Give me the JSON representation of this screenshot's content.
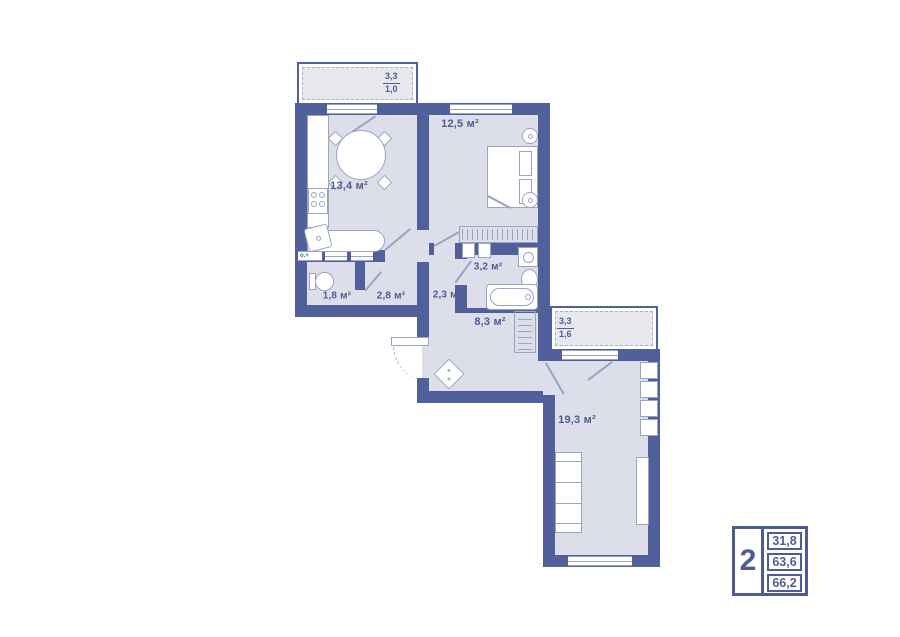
{
  "colors": {
    "wall": "#51609a",
    "floor": "#dcdee9",
    "line": "#9aa3c4",
    "text": "#4d5c94",
    "bfloor": "#e7e8ee",
    "dash": "#a9b0ca"
  },
  "rooms": {
    "kitchen": "13,4 м²",
    "bedroom": "12,5 м²",
    "bathroom": "3,2 м²",
    "wc": "1,8 м²",
    "hallway": "2,8 м²",
    "corridor": "2,3 м²",
    "hall": "8,3 м²",
    "living": "19,3 м²"
  },
  "balconies": {
    "top": {
      "upper": "3,3",
      "lower": "1,0"
    },
    "right": {
      "upper": "3,3",
      "lower": "1,6"
    }
  },
  "wc_vent_label": "о.+",
  "legend": {
    "room_count": "2",
    "values": [
      "31,8",
      "63,6",
      "66,2"
    ]
  }
}
